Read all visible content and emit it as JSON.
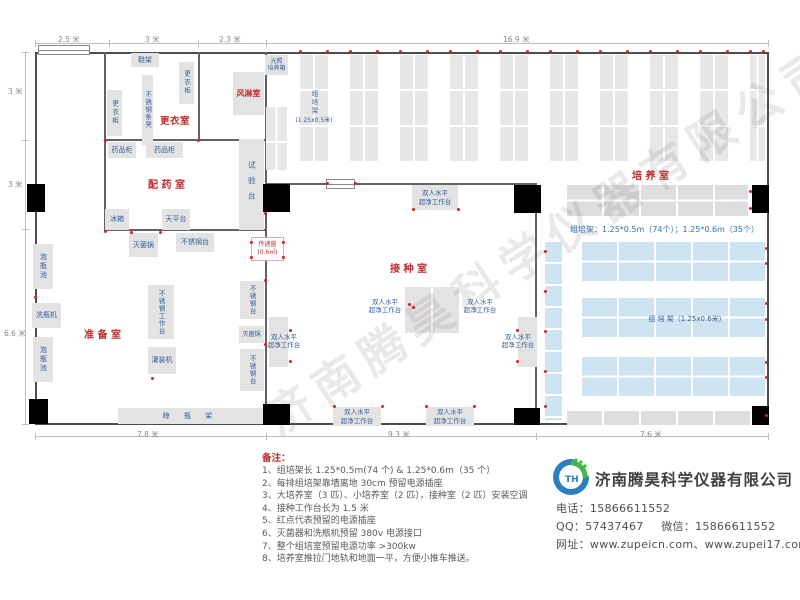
{
  "watermark": "济南腾昊科学仪器有限公司",
  "dimensions": {
    "top": [
      "2.5 米",
      "3 米",
      "2.3 米",
      "16.9 米"
    ],
    "left": [
      "3 米",
      "3 米",
      "6.6 米"
    ],
    "bottom": [
      "7.8 米",
      "9.3 米",
      "7.6 米"
    ]
  },
  "rooms": {
    "changing": "更衣室",
    "air_shower": "风淋室",
    "dispensing": "配 药 室",
    "prep": "准 备 室",
    "inoculation": "接 种 室",
    "culture": "培 养 室"
  },
  "equipment": {
    "shoe_rack": "鞋架",
    "locker": "更衣柜",
    "bench": "不锈钢条凳",
    "medicine_cabinet": "药品柜",
    "fridge": "冰箱",
    "balance_table": "天平台",
    "test_bench": "试验台",
    "sterilizer": "灭菌锅",
    "ss_table": "不锈钢台",
    "soak_pool": "泡瓶池",
    "bottle_washer": "洗瓶机",
    "ss_workbench": "不锈钢工作台",
    "filling_machine": "灌装机",
    "drying_rack": "晾 瓶 架",
    "pass_window_l1": "传递窗",
    "pass_window_l2": "(0.6㎡)",
    "light_incubator_l1": "光照",
    "light_incubator_l2": "培养箱",
    "clean_bench_l1": "双人水平",
    "clean_bench_l2": "超净工作台"
  },
  "racks": {
    "small_vertical_label": "组培架",
    "small_vertical_size": "(1.25x0.5米)",
    "big_band_label": "组 培 架（1.25x0.6米）",
    "spec_line": "组培架：1.25*0.5m（74个）；1.25*0.6m（35个）"
  },
  "notes": {
    "title": "备注：",
    "items": [
      "1、组培架长 1.25*0.5m(74 个) & 1.25*0.6m（35 个）",
      "2、每排组培架靠墙离地 30cm 预留电源插座",
      "3、大培养室（3 匹）、小培养室（2 匹），接种室（2 匹）安装空调",
      "4、接种工作台长为 1.5 米",
      "5、红点代表预留的电源插座",
      "6、灭菌器和洗瓶机预留 380v 电源接口",
      "7、整个组培室预留电源功率 >300kw",
      "8、培养室推拉门地轨和地面一平，方便小推车推送。"
    ]
  },
  "contact": {
    "logo_text": "TH",
    "company": "济南腾昊科学仪器有限公司",
    "phone_label": "电话：",
    "phone": "15866611552",
    "qq_label": "QQ：",
    "qq": "57437467",
    "wechat_label": "微信：",
    "wechat": "15866611552",
    "web_label": "网址：",
    "websites": "www.zupeicn.com、www.zupei17.com"
  }
}
